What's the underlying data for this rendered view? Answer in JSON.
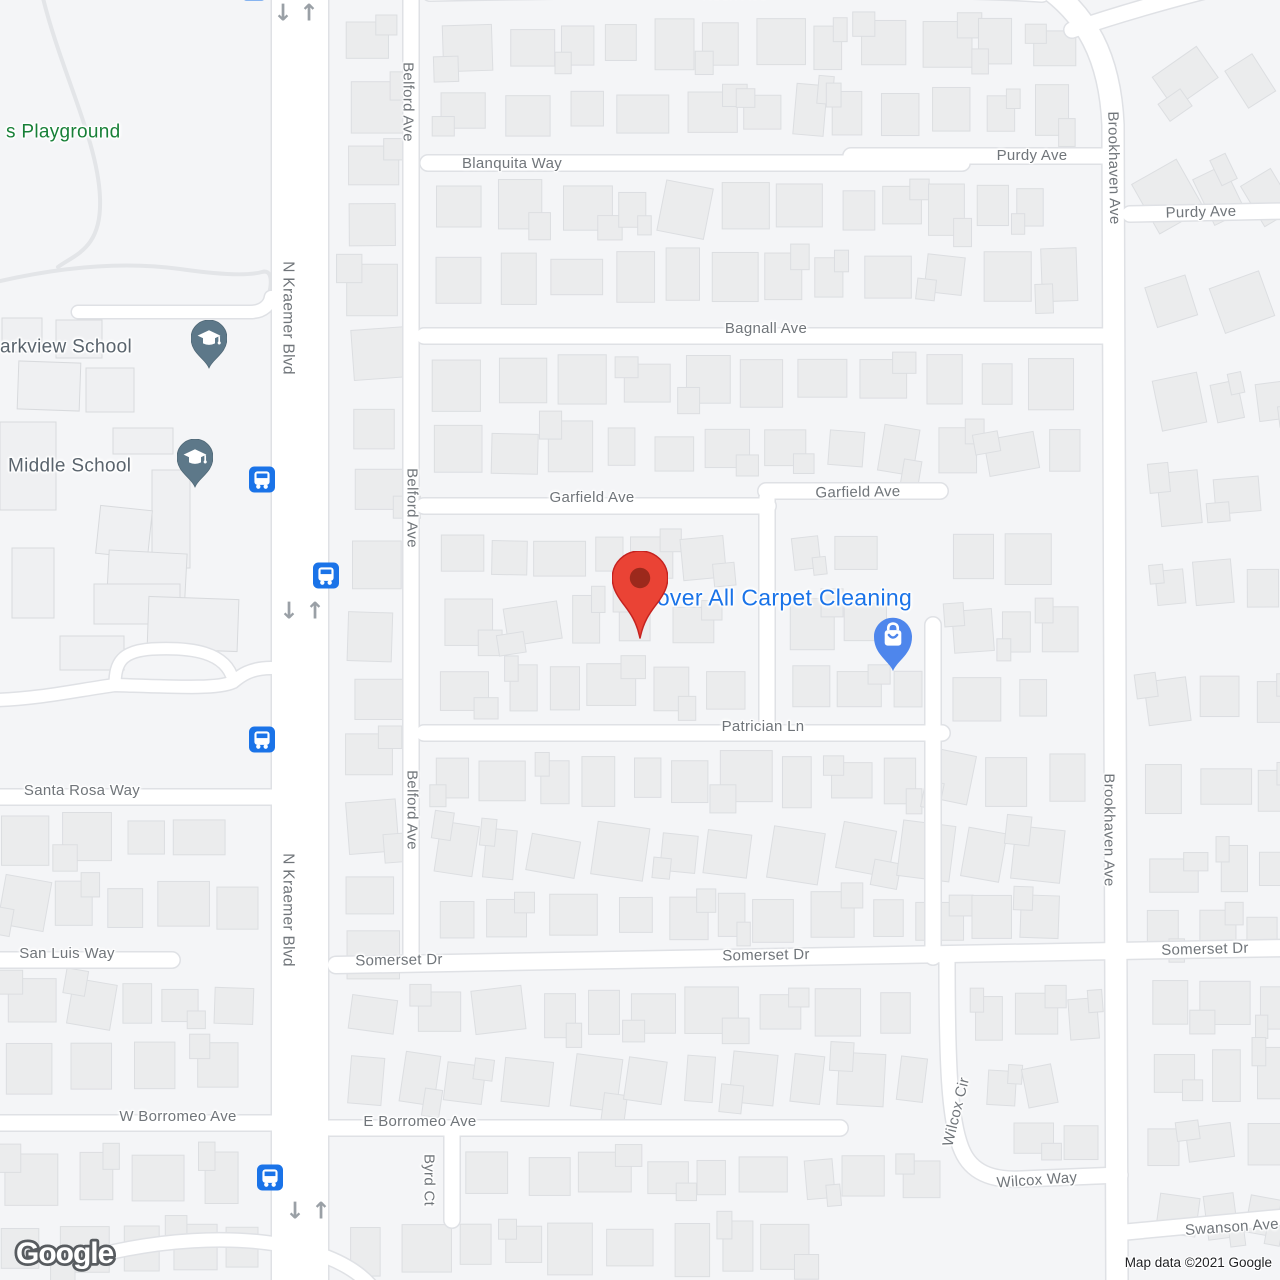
{
  "map": {
    "watermark": "Google",
    "attribution": "Map data ©2021 Google",
    "icons": {
      "down_arrow": "↓",
      "up_arrow": "↑"
    },
    "poi": {
      "playground_label": "s Playground",
      "school_parkview_label": "arkview School",
      "school_middle_label": "Middle School",
      "business_label": "Cover All Carpet Cleaning"
    },
    "streets": {
      "koch_ave": "Koch Ave",
      "blanquita_way": "Blanquita Way",
      "purdy_ave": "Purdy Ave",
      "bagnall_ave": "Bagnall Ave",
      "garfield_ave": "Garfield Ave",
      "patrician_ln": "Patrician Ln",
      "santa_rosa_way": "Santa Rosa Way",
      "san_luis_way": "San Luis Way",
      "somerset_dr": "Somerset Dr",
      "w_borromeo_ave": "W Borromeo Ave",
      "e_borromeo_ave": "E Borromeo Ave",
      "byrd_ct": "Byrd Ct",
      "wilcox_cir": "Wilcox Cir",
      "wilcox_way": "Wilcox Way",
      "swanson_ave": "Swanson Ave",
      "n_kraemer_blvd": "N Kraemer Blvd",
      "belford_ave": "Belford Ave",
      "brookhaven_ave": "Brookhaven Ave"
    },
    "colors": {
      "land": "#f4f5f7",
      "road_fill": "#ffffff",
      "road_casing": "#dfe1e5",
      "building": "#ebeced",
      "building_stroke": "#dcdee1",
      "street_label": "#70757a",
      "school_label": "#5a646d",
      "playground_green": "#188038",
      "poi_blue": "#1a73e8",
      "marker_red": "#ea4335",
      "marker_red_dark": "#8e2418",
      "store_pin_blue": "#4e86ec",
      "school_pin": "#5d7889",
      "bus_blue": "#1a73e8"
    }
  }
}
